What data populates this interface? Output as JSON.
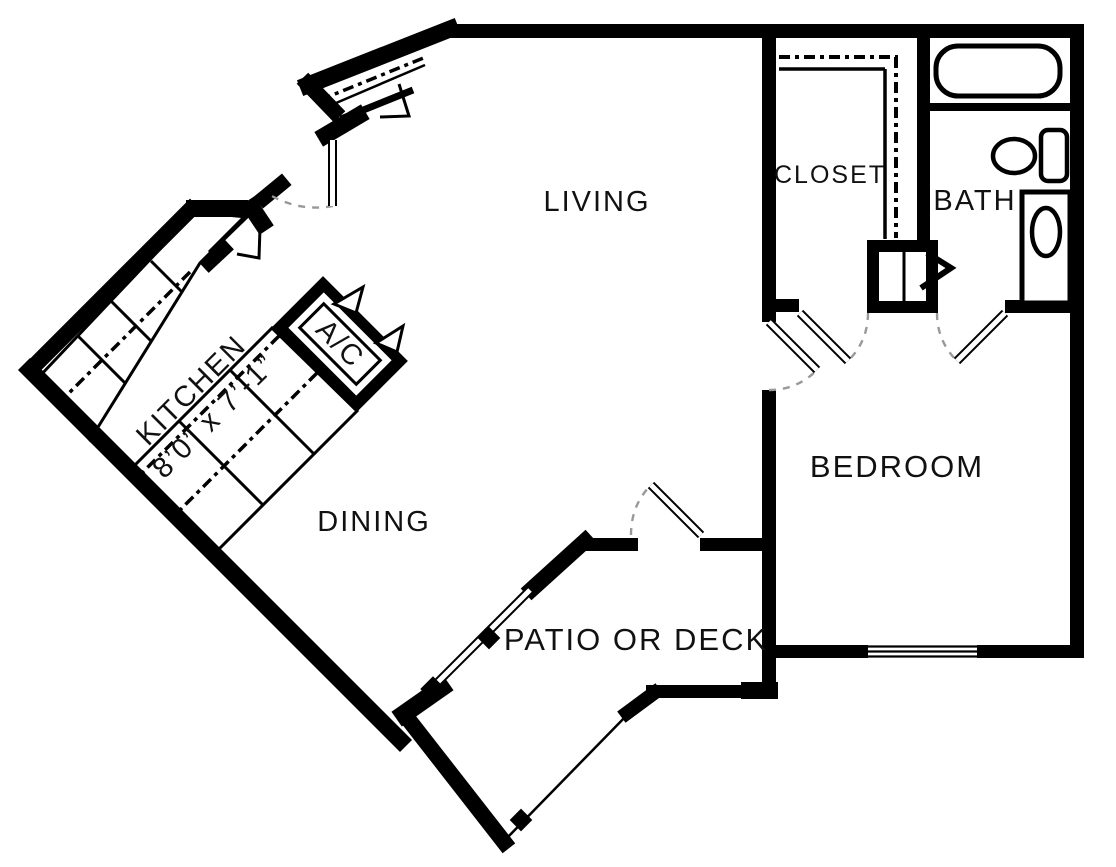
{
  "title": "One-bedroom apartment floor plan",
  "colors": {
    "wall": "#000000",
    "background": "#ffffff",
    "door_arc": "#999999",
    "door_leaf_fill": "#ffffff"
  },
  "rooms": {
    "living": {
      "label": "LIVING"
    },
    "closet": {
      "label": "CLOSET"
    },
    "bath": {
      "label": "BATH"
    },
    "bedroom": {
      "label": "BEDROOM"
    },
    "dining": {
      "label": "DINING"
    },
    "patio": {
      "label": "PATIO OR DECK"
    }
  },
  "kitchen": {
    "label": "KITCHEN",
    "dimensions": "8’0” x 7’-1”"
  },
  "hvac": {
    "label": "A/C"
  },
  "fixtures": [
    {
      "name": "bathtub"
    },
    {
      "name": "toilet"
    },
    {
      "name": "sink-vanity"
    },
    {
      "name": "closet-shelving"
    },
    {
      "name": "kitchen-counters"
    }
  ],
  "doors": [
    {
      "name": "entry-door"
    },
    {
      "name": "bedroom-door"
    },
    {
      "name": "hall-closet-door"
    },
    {
      "name": "bath-door"
    },
    {
      "name": "patio-door"
    }
  ],
  "windows": [
    {
      "name": "bedroom-window"
    },
    {
      "name": "patio-railing"
    }
  ]
}
